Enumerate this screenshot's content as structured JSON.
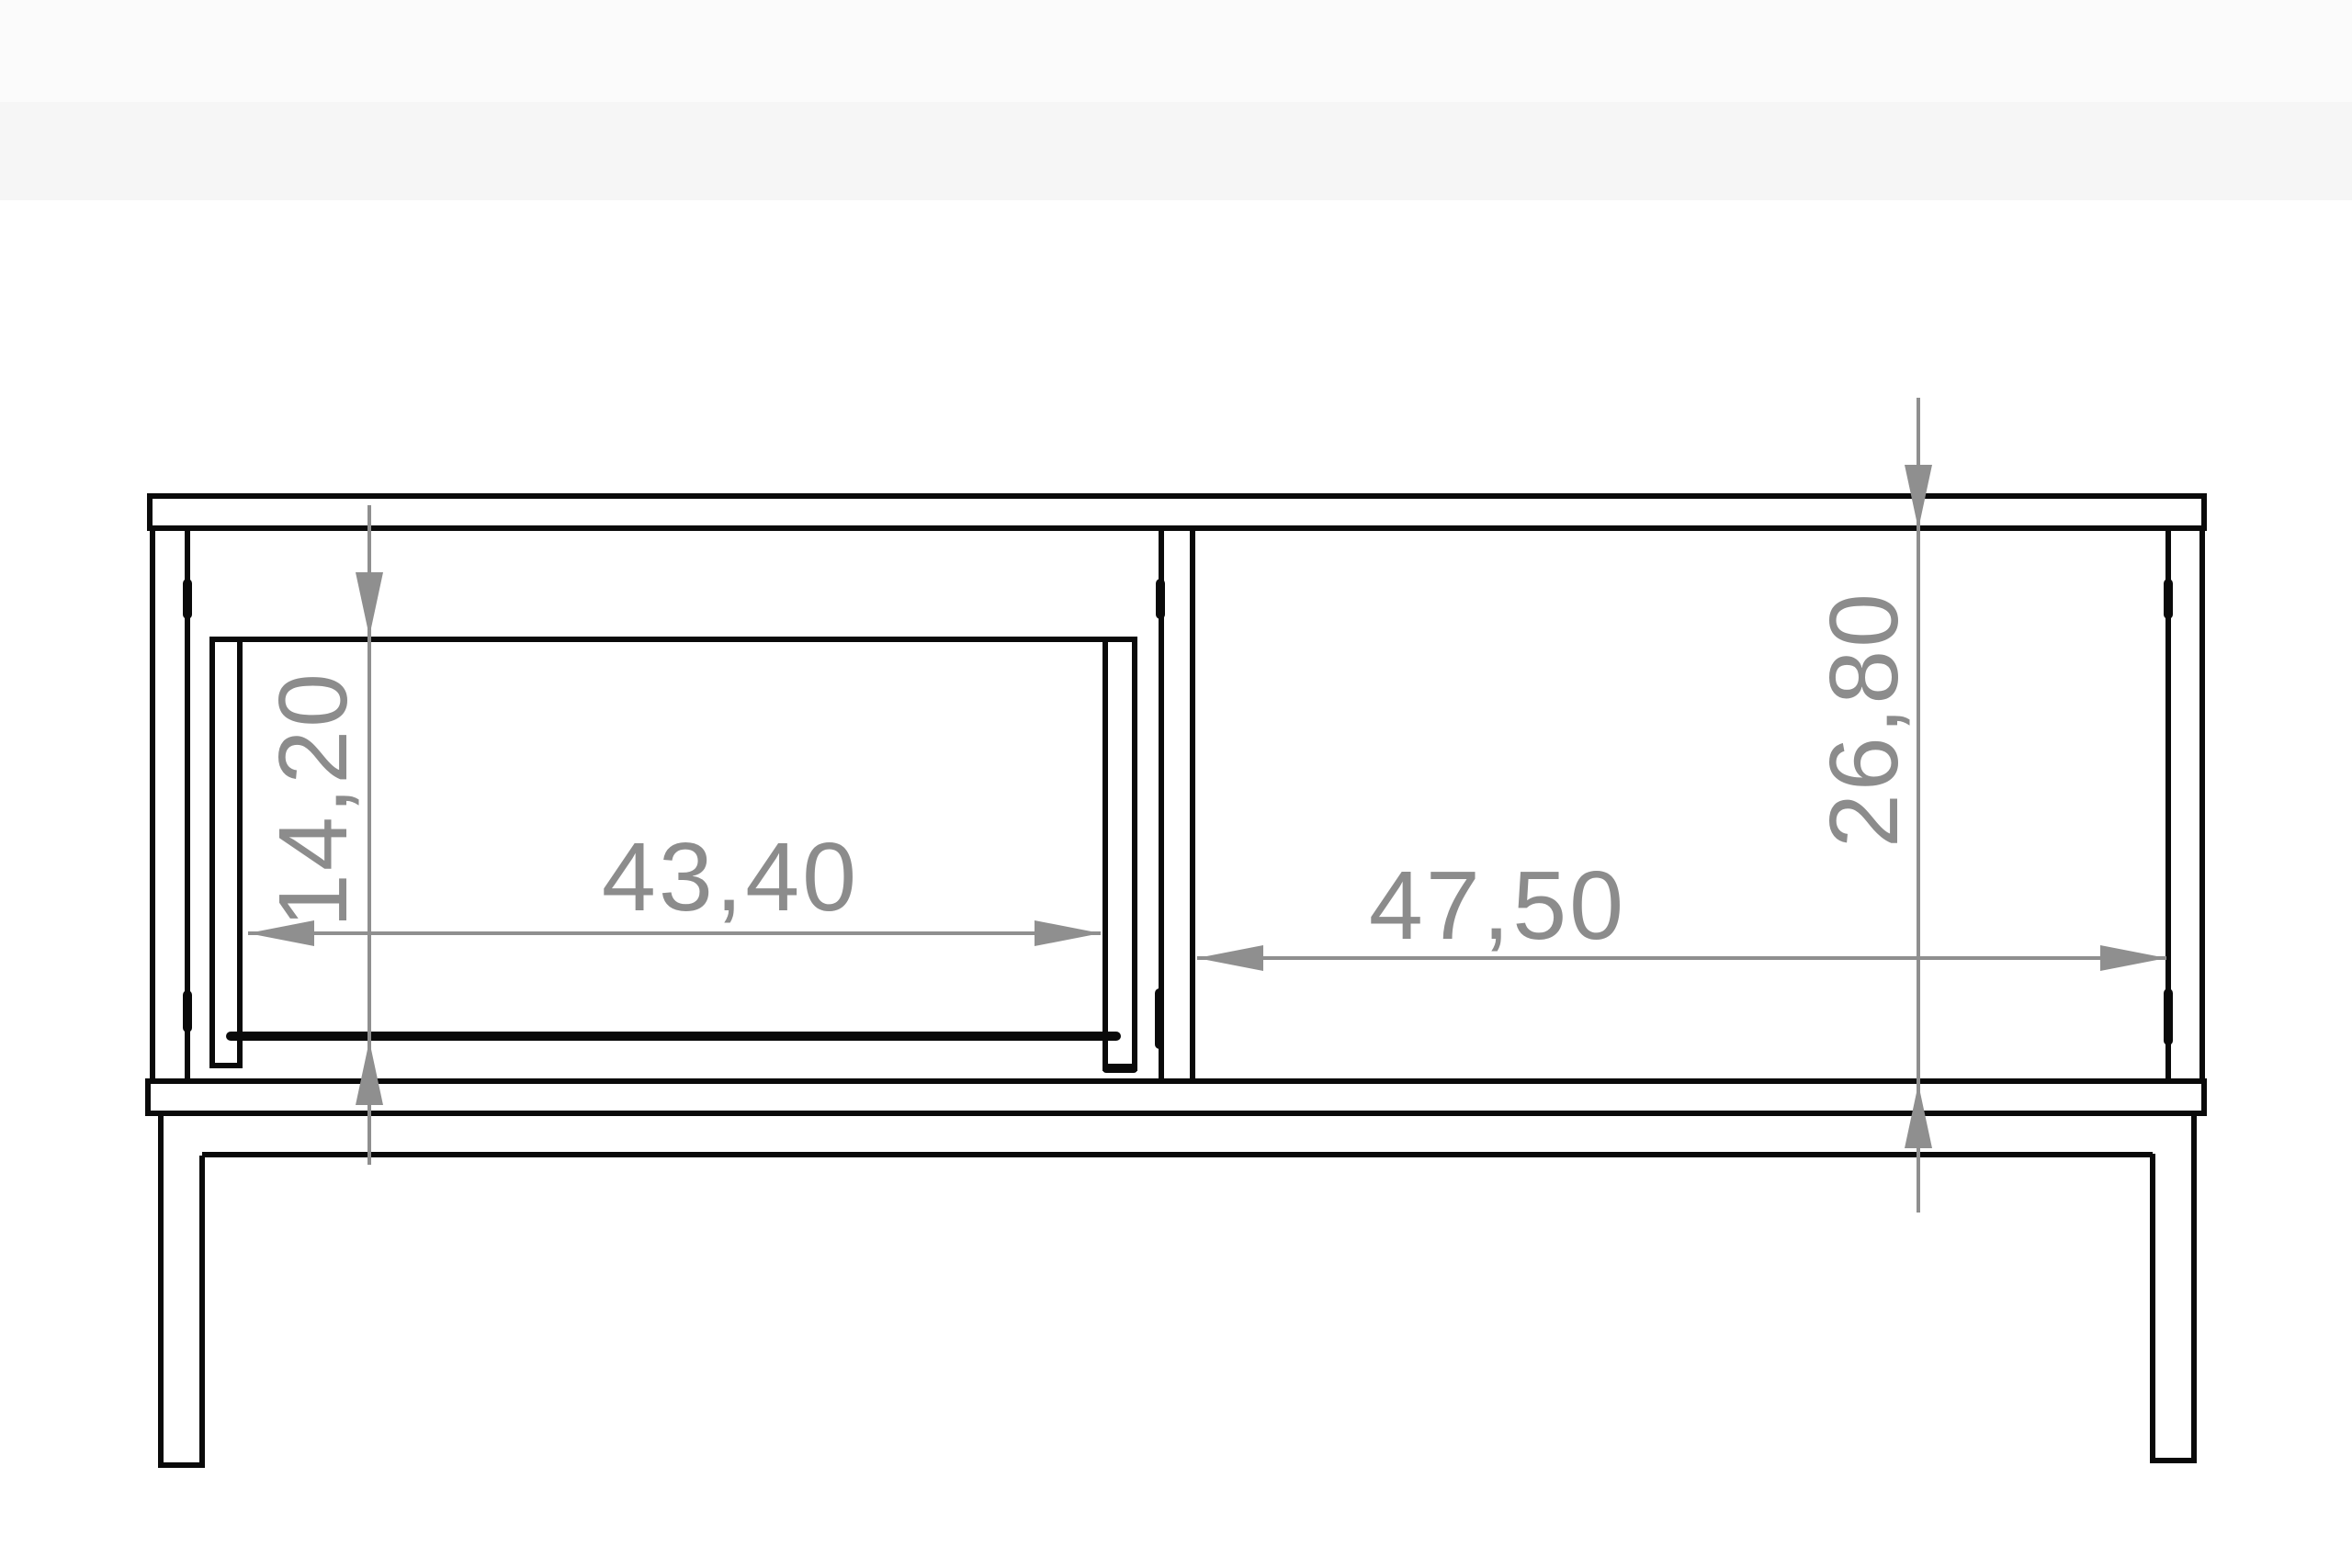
{
  "drawing": {
    "kind": "furniture-front-elevation-technical-drawing",
    "dimensions": {
      "drawer_front_height": {
        "value": "14,20",
        "orientation": "vertical"
      },
      "drawer_inner_width": {
        "value": "43,40",
        "orientation": "horizontal"
      },
      "shelf_inner_width": {
        "value": "47,50",
        "orientation": "horizontal"
      },
      "carcass_inner_height": {
        "value": "26,80",
        "orientation": "vertical"
      }
    }
  },
  "colors": {
    "background": "#ffffff",
    "band_top": "#fbfbfb",
    "band_main": "#f6f6f6",
    "line": "#0a0a0a",
    "dimension": "#8f8f8f",
    "label": "#8c8c8c"
  }
}
